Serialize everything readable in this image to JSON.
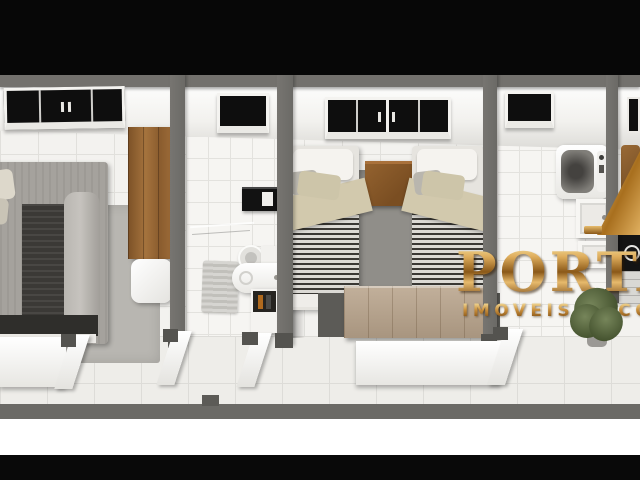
{
  "image": {
    "title": "apartment-3d-floor-plan-render",
    "style": "top-down doll-house 3D render, letterboxed with black bars",
    "watermark": {
      "brand_visible": "PORTA",
      "tagline_visible": "IMOVEIS & CO",
      "emblem": "gold-roof-peak",
      "gold_light": "#f4df9e",
      "gold_mid": "#cd9440",
      "gold_dark": "#7a4a10"
    },
    "palette": {
      "letterbox_black": "#070707",
      "outside_white": "#ffffff",
      "wall_gray": "#71706c",
      "wall_dark": "#54534f",
      "floor_tile": "#f3f2ef",
      "grout": "#deddd9",
      "wood": "#9c6b38",
      "wood_weathered": "#b7a48e",
      "charcoal_fabric": "#312f2c",
      "gray_fabric": "#a5a29d",
      "beige_throw": "#d2c9ad",
      "stripe_dark": "#3a3834",
      "plant_green": "#55663c"
    },
    "rooms": [
      {
        "id": "bedroom-main",
        "label": "double bedroom",
        "items": [
          "double-bed",
          "dark-runner",
          "wardrobe",
          "laundry-basket",
          "area-rug",
          "window"
        ]
      },
      {
        "id": "bathroom",
        "label": "bathroom",
        "items": [
          "toilet",
          "vanity-sink",
          "mirror",
          "shower-glass",
          "bath-mat",
          "toiletry-cabinet",
          "window"
        ]
      },
      {
        "id": "bedroom-twin",
        "label": "twin bedroom",
        "items": [
          "twin-bed-left",
          "twin-bed-right",
          "nightstand",
          "area-rug",
          "wood-bench",
          "window"
        ]
      },
      {
        "id": "laundry",
        "label": "laundry / service area",
        "items": [
          "washing-machine",
          "laundry-tank",
          "utility-sink",
          "potted-plant",
          "window"
        ]
      },
      {
        "id": "kitchen",
        "label": "kitchen (partially visible at right edge)",
        "items": [
          "cooktop",
          "counter-panel",
          "wood-decor",
          "window-sliver"
        ]
      }
    ],
    "doors_open": 4,
    "view": {
      "corridor": "bottom",
      "south_walls": "cut white with open door leafs"
    }
  }
}
